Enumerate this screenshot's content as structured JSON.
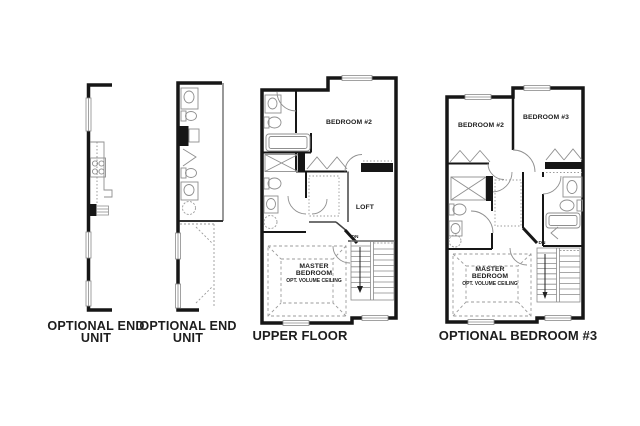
{
  "document": {
    "background_color": "#ffffff"
  },
  "colors": {
    "wall": "#161616",
    "fixture_line": "#8f8f8f",
    "dashed_line": "#9b9b9b",
    "label_text": "#1d1d1d"
  },
  "panels": {
    "end_unit_left": {
      "title": "OPTIONAL END UNIT"
    },
    "end_unit_right": {
      "title": "OPTIONAL END UNIT"
    },
    "upper_floor": {
      "title": "UPPER FLOOR",
      "labels": {
        "bedroom2": "BEDROOM #2",
        "loft": "LOFT",
        "master_bedroom": "MASTER BEDROOM",
        "master_bedroom_note": "OPT. VOLUME CEILING",
        "stair_direction": "DN"
      }
    },
    "optional_bedroom3": {
      "title": "OPTIONAL BEDROOM #3",
      "labels": {
        "bedroom2": "BEDROOM #2",
        "bedroom3": "BEDROOM #3",
        "master_bedroom": "MASTER BEDROOM",
        "master_bedroom_note": "OPT. VOLUME CEILING",
        "stair_direction": "DN"
      }
    }
  }
}
